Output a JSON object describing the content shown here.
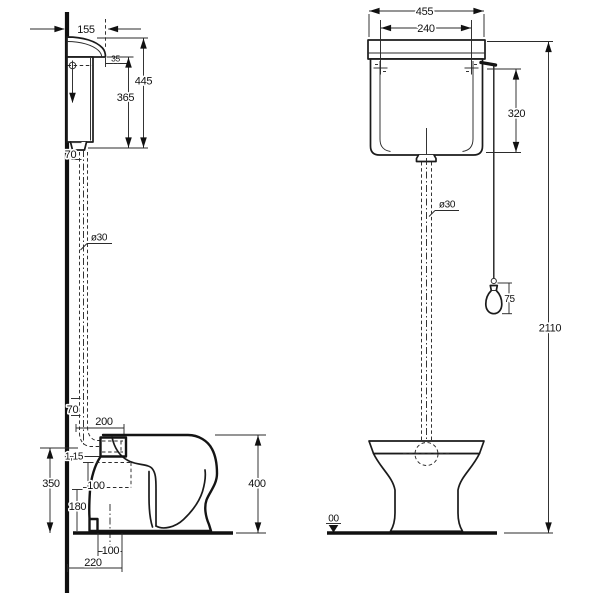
{
  "views": {
    "side": {
      "name": "side-elevation",
      "dims": {
        "cistern_depth": "155",
        "lid_lip": "35",
        "cistern_overall_height": "445",
        "cistern_body_height": "365",
        "pipe_top_offset": "70",
        "pipe_diameter": "ø30",
        "pipe_bottom_offset": "70",
        "inlet_projection": "200",
        "wall_to_pan_rear": "1,15",
        "inlet_height": "350",
        "outlet_size": "100",
        "outlet_height": "180",
        "pan_height": "400",
        "outlet_offset": "100",
        "wall_to_outlet": "220"
      }
    },
    "front": {
      "name": "front-elevation",
      "dims": {
        "cistern_width": "455",
        "fixing_hole_centres": "240",
        "chain_drop": "320",
        "pipe_diameter": "ø30",
        "handle_length": "75",
        "overall_height": "2110",
        "floor_datum": "00"
      }
    }
  }
}
